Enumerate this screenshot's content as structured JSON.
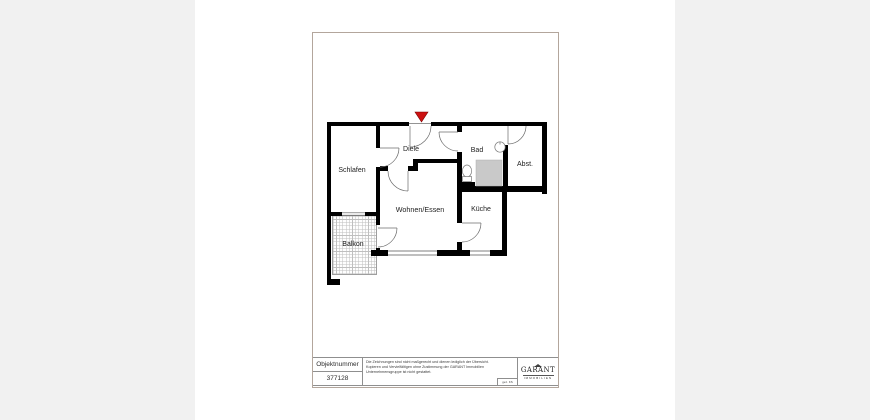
{
  "page": {
    "floor_plan": {
      "rooms": [
        {
          "id": "schlafen",
          "label": "Schlafen"
        },
        {
          "id": "diele",
          "label": "Diele"
        },
        {
          "id": "bad",
          "label": "Bad"
        },
        {
          "id": "abst",
          "label": "Abst."
        },
        {
          "id": "wohnen_essen",
          "label": "Wohnen/Essen"
        },
        {
          "id": "kueche",
          "label": "Küche"
        },
        {
          "id": "balkon",
          "label": "Balkon"
        }
      ],
      "colors": {
        "wall": "#000000",
        "entrance_marker": "#cc1111",
        "shower_fill": "#c9c9c9",
        "hatch_line": "#bfbfbf",
        "page_border": "#b3a69c"
      }
    },
    "title_block": {
      "objektnummer_label": "Objektnummer",
      "objektnummer_value": "377128",
      "disclaimer_line1": "Die Zeichnungen sind nicht maßgerecht und dienen lediglich der Übersicht.",
      "disclaimer_line2": "Kopieren und Vervielfältigen ohne Zustimmung der GARANT Immobilien",
      "disclaimer_line3": "Unternehmensgruppe ist nicht gestattet.",
      "signature": "gez. KS",
      "logo": {
        "name": "GARANT",
        "subtitle": "IMMOBILIEN"
      }
    }
  }
}
